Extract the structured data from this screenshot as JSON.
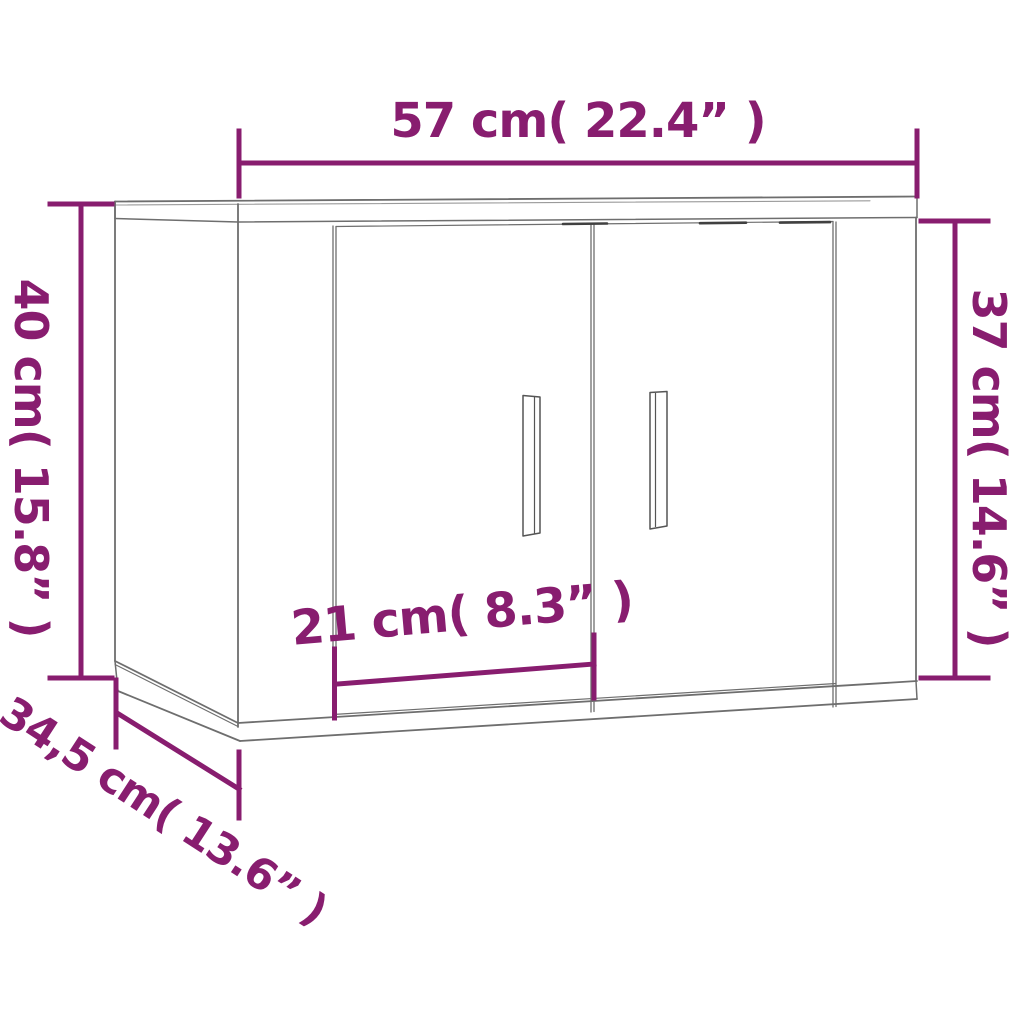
{
  "diagram": {
    "type": "furniture-dimension-line-drawing",
    "subject": "wall-mounted cabinet with two doors",
    "colors": {
      "accent": "#881d6f",
      "outline": "#6e6e6e",
      "background": "#ffffff"
    },
    "dimensions": {
      "width": {
        "label": "57 cm( 22.4” )",
        "value_cm": 57,
        "value_inch": 22.4,
        "position": "top"
      },
      "height": {
        "label": "40 cm( 15.8” )",
        "value_cm": 40,
        "value_inch": 15.8,
        "position": "left"
      },
      "side_height": {
        "label": "37 cm( 14.6” )",
        "value_cm": 37,
        "value_inch": 14.6,
        "position": "right"
      },
      "door_width": {
        "label": "21 cm( 8.3” )",
        "value_cm": 21,
        "value_inch": 8.3,
        "position": "bottom-center"
      },
      "depth": {
        "label": "34,5 cm( 13.6” )",
        "value_cm": 34.5,
        "value_inch": 13.6,
        "position": "bottom-left-diagonal"
      }
    }
  }
}
